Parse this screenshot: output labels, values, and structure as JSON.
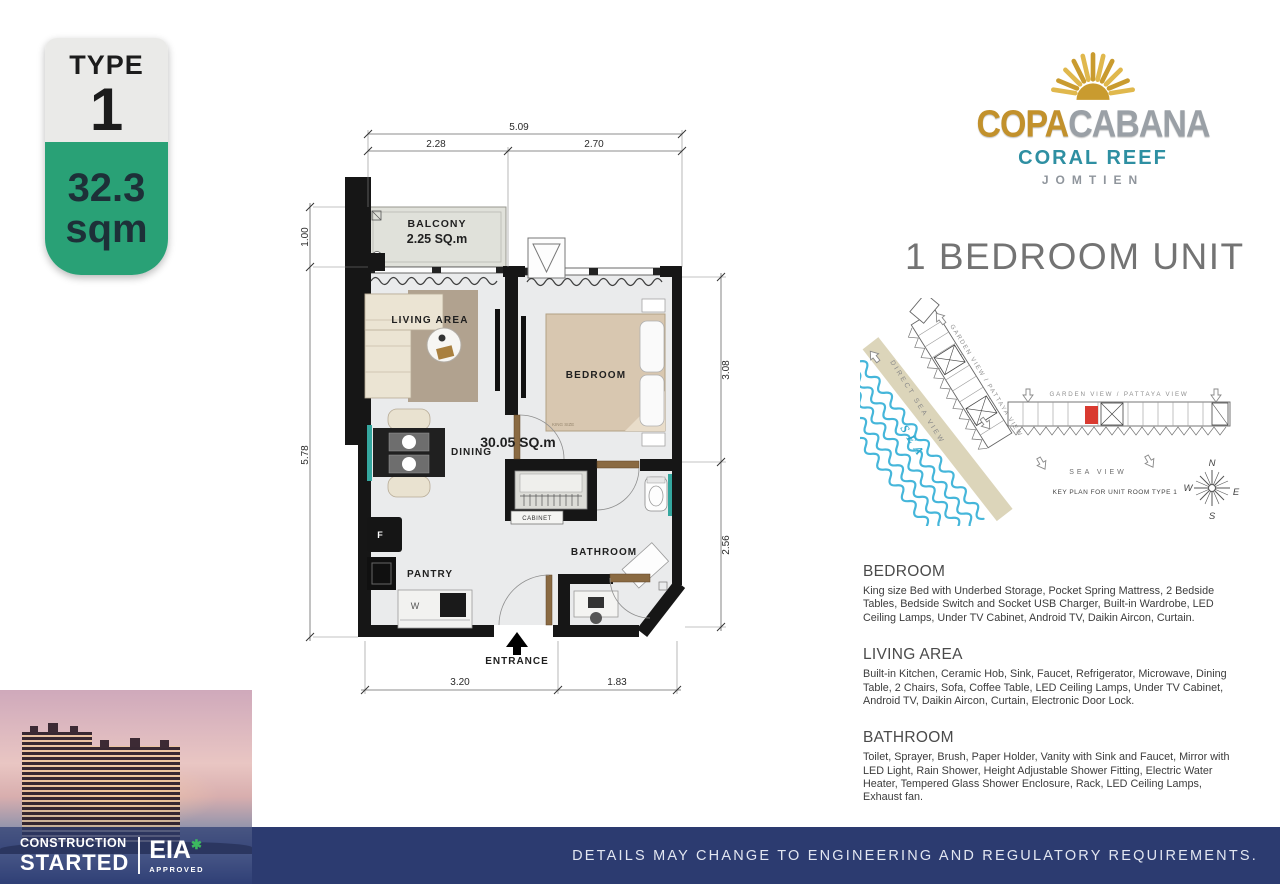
{
  "badge": {
    "type_label": "TYPE",
    "type_number": "1",
    "area_value": "32.3",
    "area_unit": "sqm"
  },
  "logo": {
    "brand_gold": "COPA",
    "brand_silver": "CABANA",
    "line2": "CORAL REEF",
    "line3": "JOMTIEN"
  },
  "unit_title": "1 BEDROOM UNIT",
  "floorplan": {
    "labels": {
      "balcony": "BALCONY",
      "balcony_area": "2.25 SQ.m",
      "living": "LIVING AREA",
      "bedroom": "BEDROOM",
      "dining": "DINING",
      "pantry": "PANTRY",
      "bathroom": "BATHROOM",
      "cabinet": "CABINET",
      "entrance": "ENTRANCE",
      "unit_area": "30.05 SQ.m",
      "bed_size": "KING SIZE",
      "fridge": "F",
      "washer": "W"
    },
    "dimensions": {
      "top_total": "5.09",
      "top_left": "2.28",
      "top_right": "2.70",
      "left_top": "1.00",
      "left_bottom": "5.78",
      "right_top": "3.08",
      "right_bottom": "2.56",
      "bottom_left": "3.20",
      "bottom_right": "1.83"
    }
  },
  "keyplan": {
    "label_garden_diagonal": "GARDEN VIEW / PATTAYA VIEW",
    "label_garden_horizontal": "GARDEN VIEW / PATTAYA VIEW",
    "label_direct_sea": "DIRECT SEA VIEW",
    "label_sea": "SEA",
    "label_sea_view": "SEA VIEW",
    "caption": "KEY PLAN FOR UNIT ROOM TYPE 1",
    "compass": {
      "n": "N",
      "e": "E",
      "s": "S",
      "w": "W"
    }
  },
  "specs": [
    {
      "heading": "BEDROOM",
      "body": "King size Bed with Underbed Storage, Pocket Spring Mattress, 2 Bedside Tables, Bedside Switch and Socket USB Charger, Built-in Wardrobe, LED Ceiling Lamps, Under TV Cabinet, Android TV, Daikin Aircon, Curtain."
    },
    {
      "heading": "LIVING AREA",
      "body": "Built-in Kitchen, Ceramic Hob, Sink, Faucet, Refrigerator, Microwave, Dining Table, 2 Chairs, Sofa, Coffee Table, LED Ceiling Lamps, Under TV Cabinet, Android TV, Daikin Aircon, Curtain, Electronic Door Lock."
    },
    {
      "heading": "BATHROOM",
      "body": "Toilet, Sprayer, Brush, Paper Holder, Vanity with Sink and Faucet, Mirror with LED Light, Rain Shower, Height Adjustable Shower Fitting, Electric Water Heater, Tempered Glass Shower Enclosure, Rack, LED Ceiling Lamps, Exhaust fan."
    }
  ],
  "construction": {
    "line1": "CONSTRUCTION",
    "line2": "STARTED",
    "eia": "EIA",
    "star": "✱",
    "approved": "APPROVED"
  },
  "footer": {
    "disclaimer": "DETAILS MAY CHANGE TO ENGINEERING AND REGULATORY REQUIREMENTS."
  },
  "colors": {
    "accent_green": "#29a176",
    "navy_bar": "#2c3b70",
    "teal_accent": "#35a79f",
    "logo_gold": "#c2912c",
    "logo_teal": "#2e8fa2",
    "unit_marker_red": "#d93a30"
  }
}
